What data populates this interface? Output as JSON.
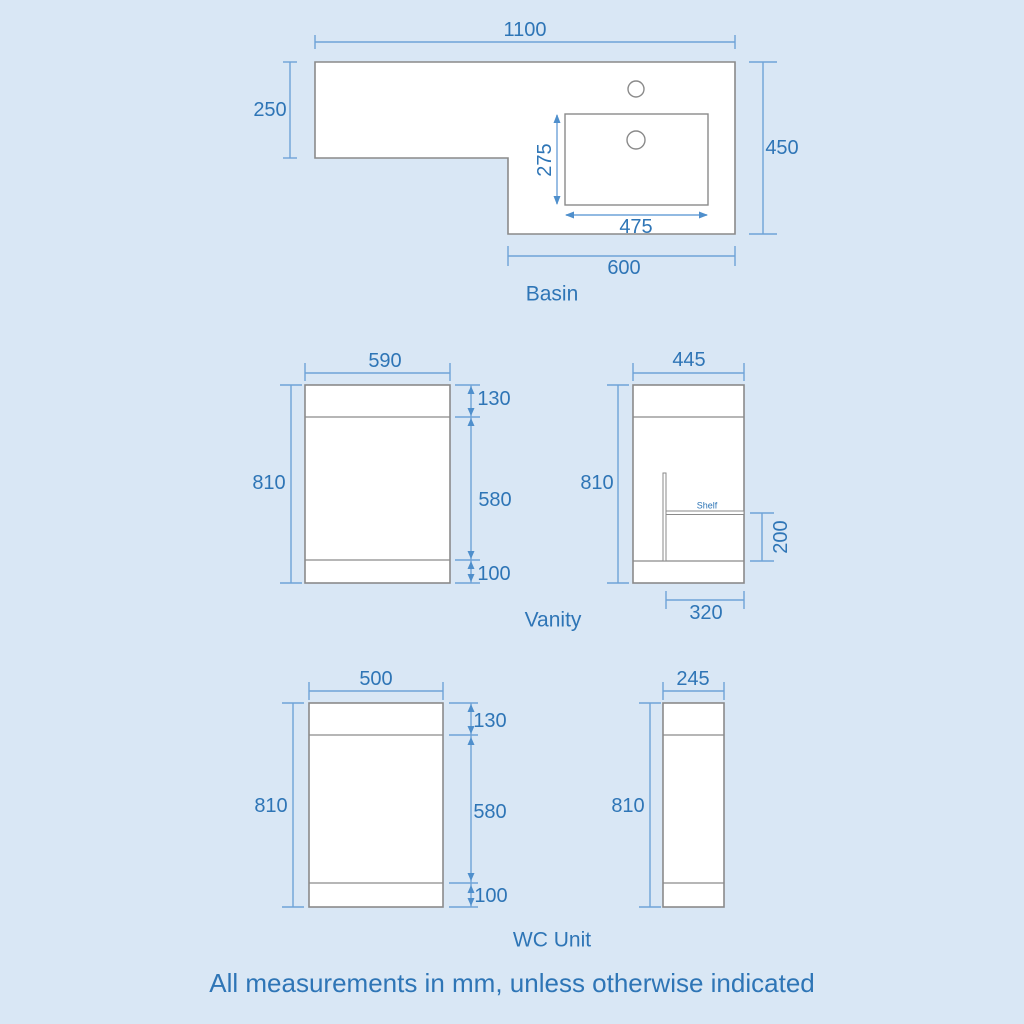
{
  "note": "All measurements in mm, unless otherwise indicated",
  "colors": {
    "background": "#d9e7f5",
    "text": "#2e75b6",
    "dimension_line": "#6fa3d8",
    "shape_outline": "#8a8a8a",
    "shape_fill": "#ffffff"
  },
  "basin": {
    "label": "Basin",
    "dim_top_width": "1100",
    "dim_left_height": "250",
    "dim_right_height": "450",
    "dim_sink_depth": "275",
    "dim_sink_width": "475",
    "dim_bottom_width": "600"
  },
  "vanity": {
    "label": "Vanity",
    "front": {
      "dim_width": "590",
      "dim_height": "810",
      "dim_top": "130",
      "dim_middle": "580",
      "dim_bottom": "100"
    },
    "side": {
      "dim_width": "445",
      "dim_height": "810",
      "shelf_label": "Shelf",
      "dim_shelf_height": "200",
      "dim_shelf_depth": "320"
    }
  },
  "wc_unit": {
    "label": "WC Unit",
    "front": {
      "dim_width": "500",
      "dim_height": "810",
      "dim_top": "130",
      "dim_middle": "580",
      "dim_bottom": "100"
    },
    "side": {
      "dim_width": "245",
      "dim_height": "810"
    }
  }
}
